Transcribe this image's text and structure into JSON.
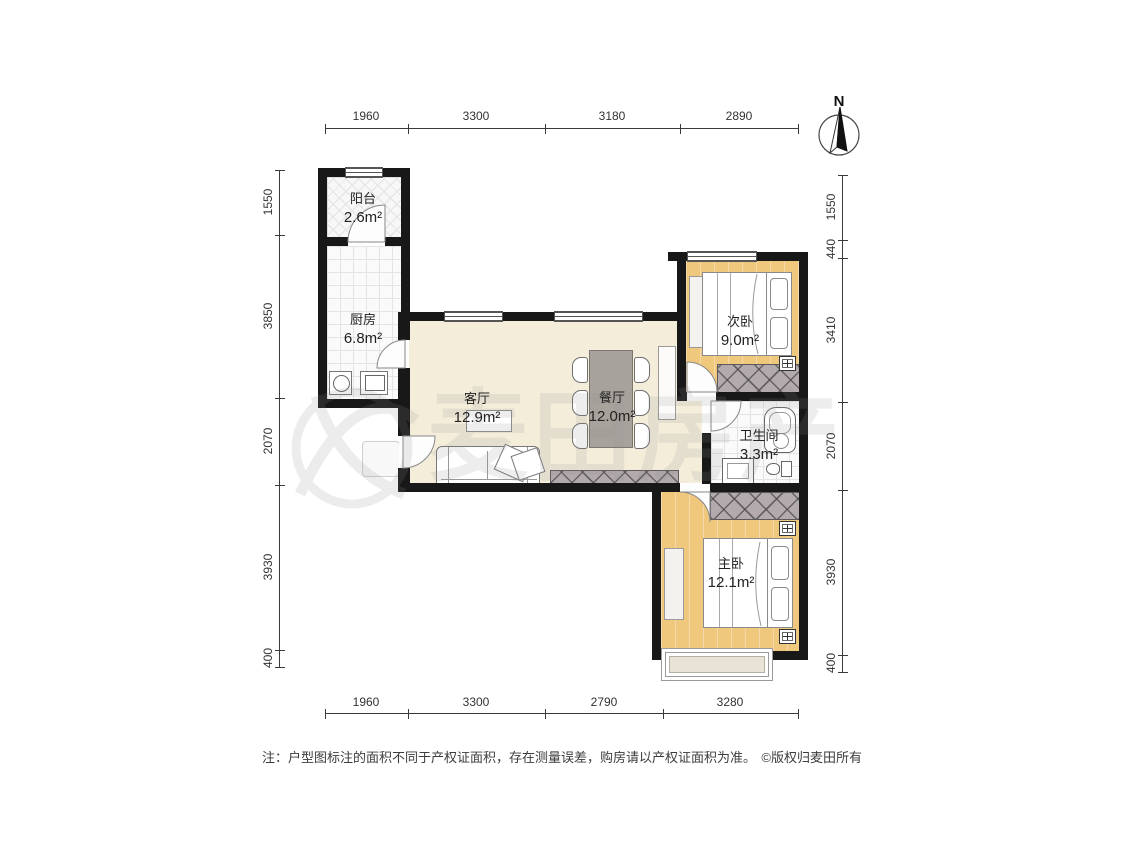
{
  "plan": {
    "compass_label": "N",
    "watermark_text": "麦田房产",
    "rooms": {
      "balcony": {
        "name": "阳台",
        "area": "2.6m²"
      },
      "kitchen": {
        "name": "厨房",
        "area": "6.8m²"
      },
      "living": {
        "name": "客厅",
        "area": "12.9m²"
      },
      "dining": {
        "name": "餐厅",
        "area": "12.0m²"
      },
      "bedroom2": {
        "name": "次卧",
        "area": "9.0m²"
      },
      "bathroom": {
        "name": "卫生间",
        "area": "3.3m²"
      },
      "master": {
        "name": "主卧",
        "area": "12.1m²"
      }
    },
    "dimensions": {
      "top": [
        "1960",
        "3300",
        "3180",
        "2890"
      ],
      "bottom": [
        "1960",
        "3300",
        "2790",
        "3280"
      ],
      "left": [
        "1550",
        "3850",
        "2070",
        "3930",
        "400"
      ],
      "right": [
        "1550",
        "440",
        "3410",
        "2070",
        "3930",
        "400"
      ]
    },
    "footer": {
      "note": "注：户型图标注的面积不同于产权证面积，存在测量误差，购房请以产权证面积为准。",
      "copyright": "©版权归麦田所有"
    },
    "colors": {
      "wall": "#181818",
      "floor_living": "#f4edda",
      "floor_wood": "#efc77d",
      "floor_tile": "#fafafa",
      "wardrobe_gray": "#b2aaad",
      "dining_table": "#a8a29c"
    }
  }
}
